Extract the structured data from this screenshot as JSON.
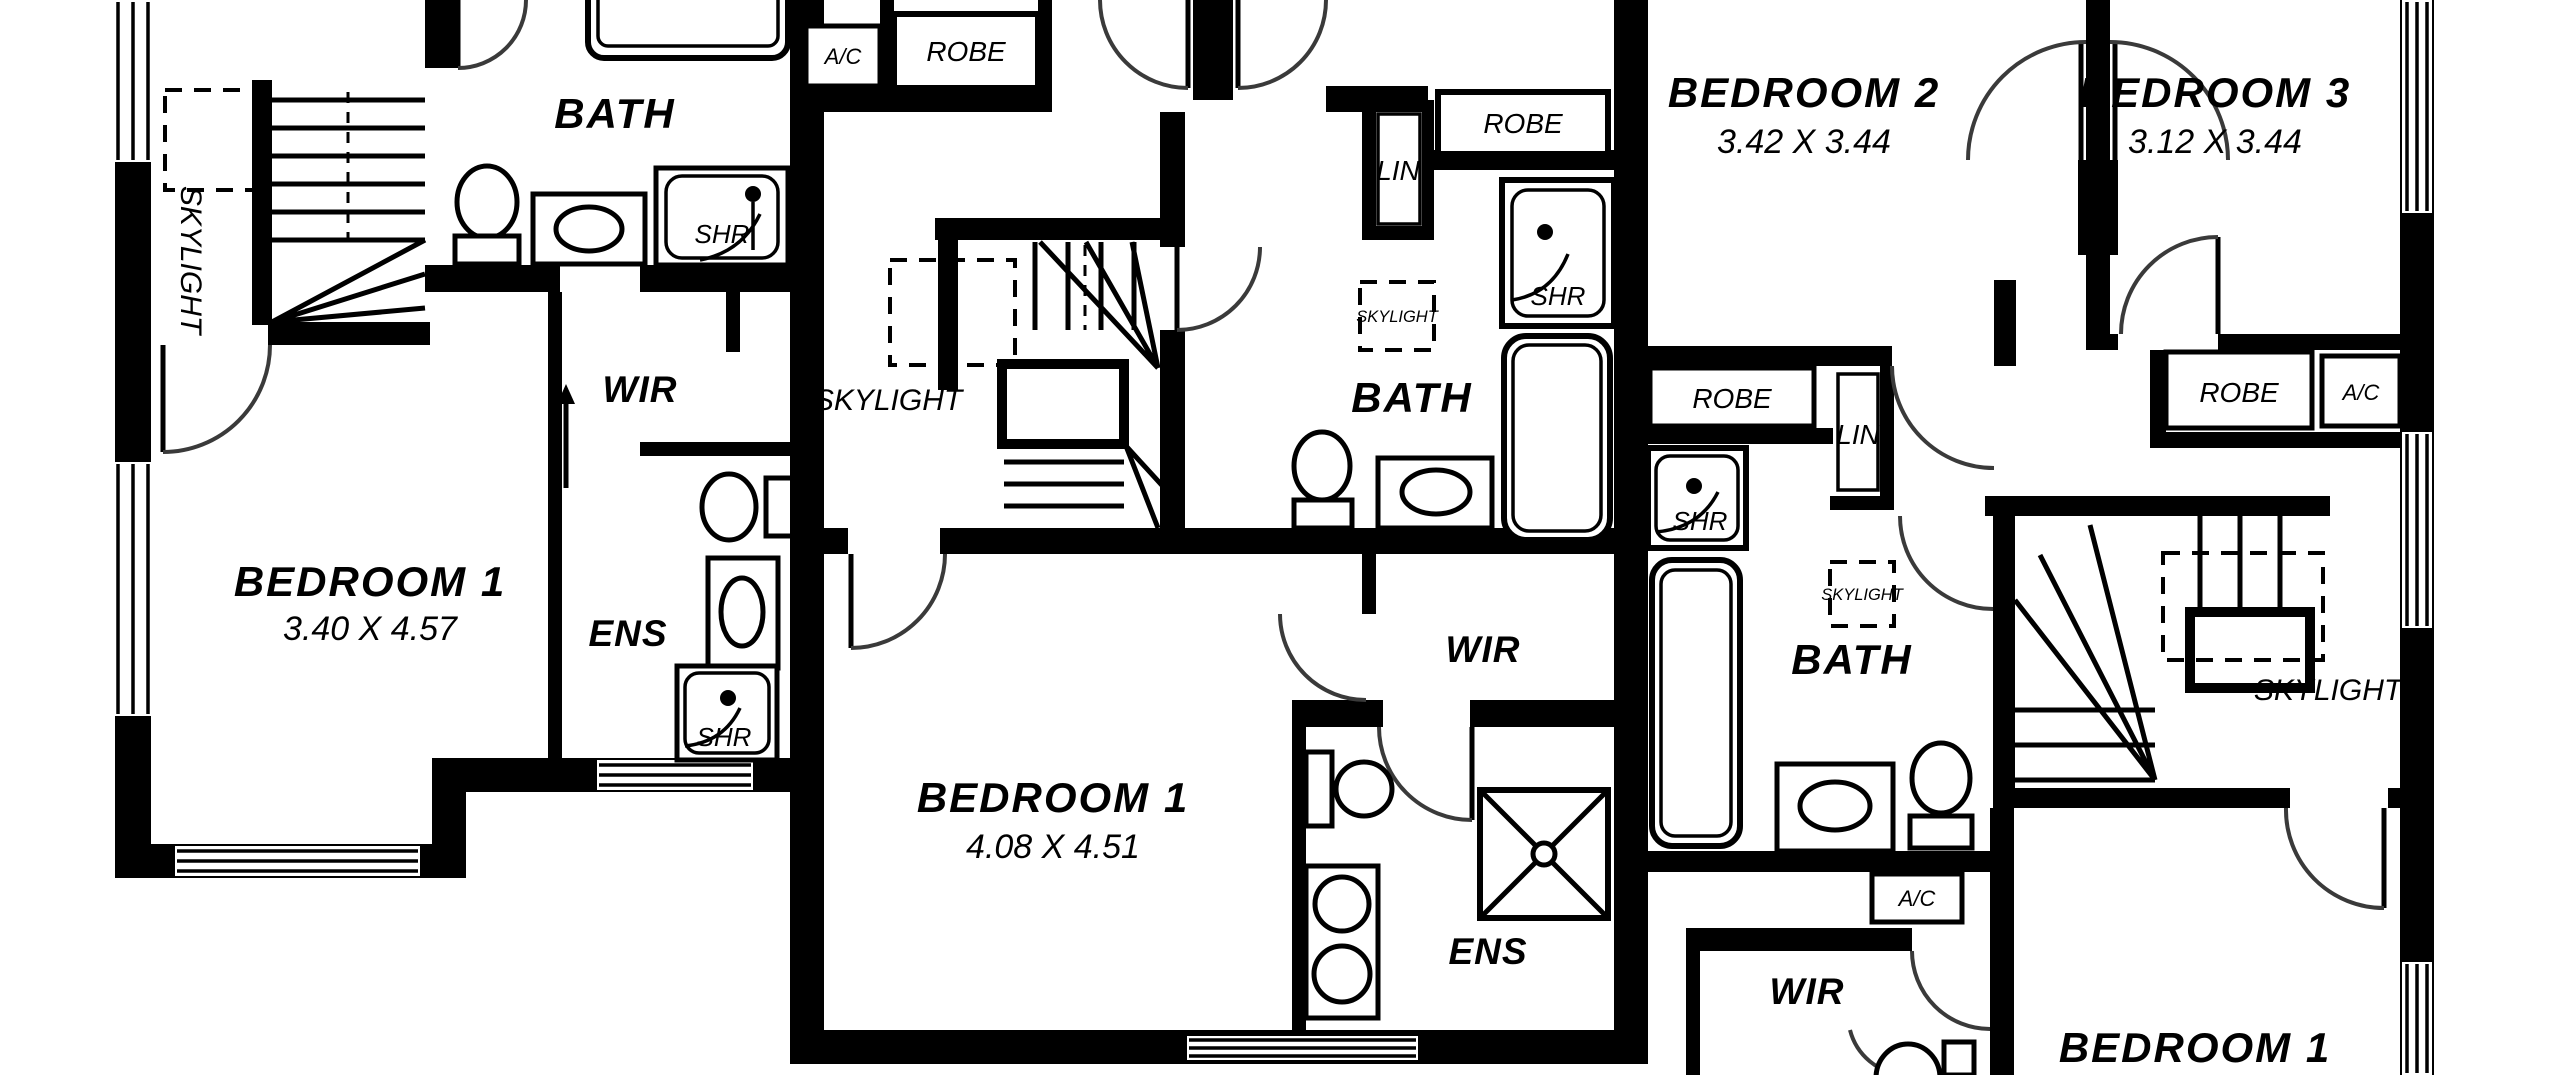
{
  "drawing_type": "floor-plan",
  "colors": {
    "walls": "#000000",
    "background": "#ffffff",
    "door_arcs": "#3a3a3a"
  },
  "labels": {
    "left_unit": {
      "skylight": "SKYLIGHT",
      "bath": "BATH",
      "shr_bath": "SHR",
      "wir": "WIR",
      "ens": "ENS",
      "shr_ens": "SHR",
      "bedroom1": "BEDROOM 1",
      "bedroom1_dims": "3.40 X 4.57"
    },
    "middle_unit": {
      "ac": "A/C",
      "robe": "ROBE",
      "lin": "LIN",
      "robe2": "ROBE",
      "shr": "SHR",
      "skylight_stair": "SKYLIGHT",
      "skylight_bath": "SKYLIGHT",
      "bath": "BATH",
      "bedroom1": "BEDROOM 1",
      "bedroom1_dims": "4.08 X 4.51",
      "wir": "WIR",
      "ens": "ENS"
    },
    "right_unit": {
      "bedroom2": "BEDROOM 2",
      "bedroom2_dims": "3.42 X 3.44",
      "bedroom3": "BEDROOM 3",
      "bedroom3_dims": "3.12 X 3.44",
      "robe_hall": "ROBE",
      "lin": "LIN",
      "shr": "SHR",
      "skylight_bath": "SKYLIGHT",
      "bath": "BATH",
      "skylight_stair": "SKYLIGHT",
      "robe_bed3": "ROBE",
      "ac_bed3": "A/C",
      "ac_lower": "A/C",
      "wir": "WIR",
      "bedroom1": "BEDROOM 1"
    }
  }
}
